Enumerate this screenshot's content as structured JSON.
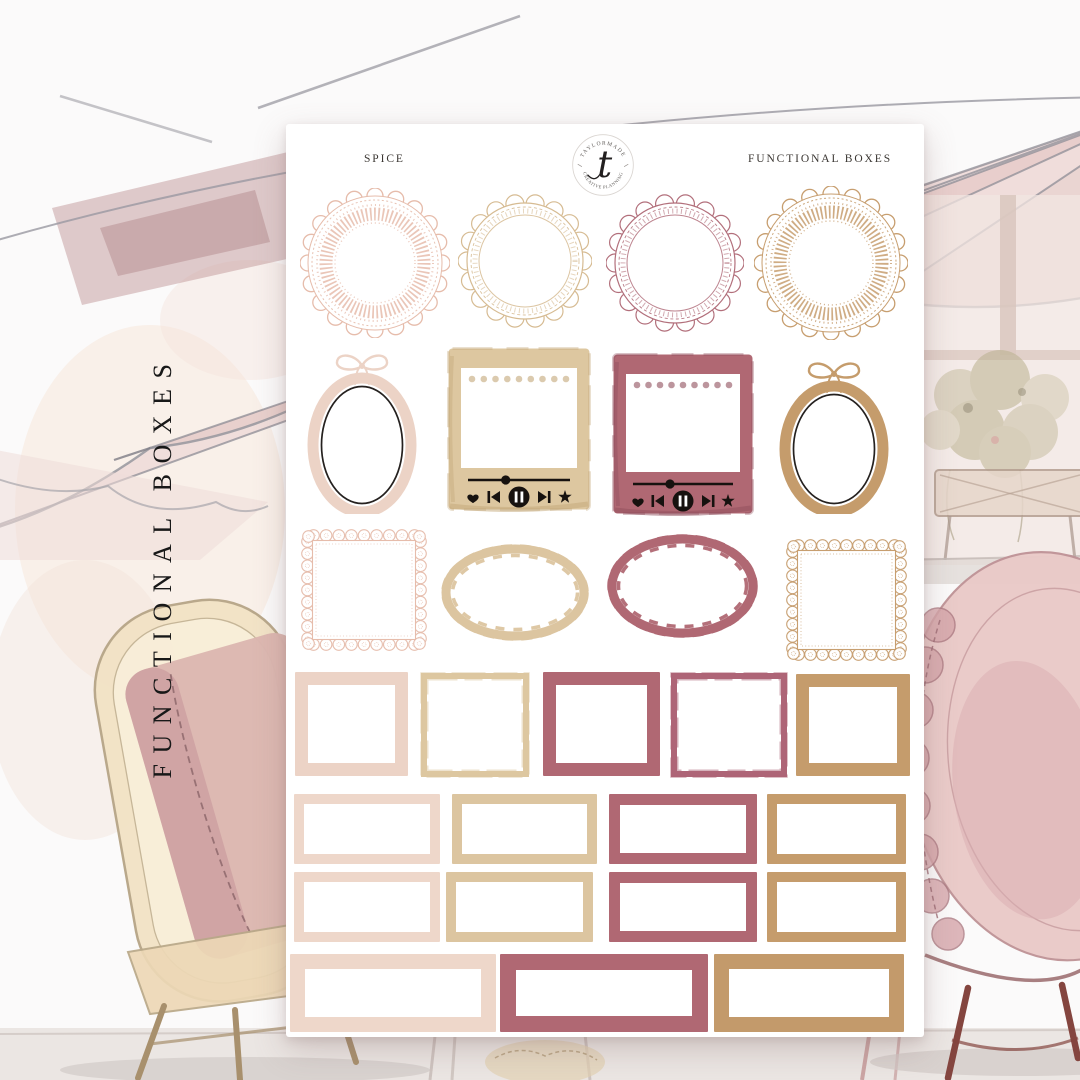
{
  "page": {
    "vertical_label": "FUNCTIONAL BOXES"
  },
  "sheet": {
    "header": {
      "collection": "SPICE",
      "product": "FUNCTIONAL BOXES"
    },
    "logo": {
      "top_arc": "TAYLORMADE",
      "bottom_arc": "CREATIVE PLANNING",
      "monogram": "t"
    }
  },
  "colors": {
    "blush": "#ecd3c6",
    "blush_light": "#eed7ca",
    "cream": "#ddc7a0",
    "cream_dark": "#c3a778",
    "tan": "#dcc5a0",
    "mauve": "#b06873",
    "mauve_brush": "#ae6577",
    "mauve_dark": "#8f4e5c",
    "camel": "#c59c6c",
    "camel_deep": "#c39a6b",
    "doily_blush": "#e6bcab",
    "doily_cream": "#d6bb92",
    "doily_mauve": "#b26f7b",
    "doily_camel": "#c79e6f",
    "ink": "#1c1c1c",
    "sheet": "#ffffff"
  },
  "stickers": {
    "rows": [
      {
        "id": "doilies",
        "items": [
          {
            "shape": "doily-wide",
            "color": "doily_blush",
            "name": "doily-sticker-blush"
          },
          {
            "shape": "doily-thin",
            "color": "doily_cream",
            "name": "doily-sticker-cream"
          },
          {
            "shape": "doily-thin",
            "color": "doily_mauve",
            "name": "doily-sticker-mauve"
          },
          {
            "shape": "doily-wide",
            "color": "doily_camel",
            "name": "doily-sticker-camel"
          }
        ]
      },
      {
        "id": "oval-frames-and-players",
        "items": [
          {
            "shape": "oval-bow",
            "color": "blush",
            "name": "oval-bow-frame-blush"
          },
          {
            "shape": "music-player",
            "color": "cream",
            "color2": "cream_dark",
            "name": "music-player-sticker-cream"
          },
          {
            "shape": "music-player",
            "color": "mauve",
            "color2": "mauve_dark",
            "name": "music-player-sticker-mauve"
          },
          {
            "shape": "oval-bow",
            "color": "camel",
            "name": "oval-bow-frame-camel"
          }
        ]
      },
      {
        "id": "lace-squares-and-wavy-ovals",
        "items": [
          {
            "shape": "lace-square",
            "color": "doily_blush",
            "name": "lace-square-frame-blush"
          },
          {
            "shape": "wavy-oval",
            "color": "tan",
            "name": "wavy-oval-frame-tan"
          },
          {
            "shape": "wavy-oval",
            "color": "mauve",
            "name": "wavy-oval-frame-mauve"
          },
          {
            "shape": "lace-square",
            "color": "doily_camel",
            "name": "lace-square-frame-camel"
          }
        ]
      },
      {
        "id": "full-boxes",
        "items": [
          {
            "shape": "solid-box",
            "color": "blush",
            "name": "full-box-blush"
          },
          {
            "shape": "brush-box",
            "color": "cream",
            "name": "full-box-brushstroke-cream"
          },
          {
            "shape": "solid-box",
            "color": "mauve",
            "name": "full-box-mauve"
          },
          {
            "shape": "brush-box",
            "color": "mauve_brush",
            "name": "full-box-brushstroke-mauve"
          },
          {
            "shape": "solid-box",
            "color": "camel",
            "name": "full-box-camel"
          }
        ]
      },
      {
        "id": "half-boxes-row-1",
        "items": [
          {
            "shape": "solid-box",
            "color": "blush_light",
            "name": "half-box-blush"
          },
          {
            "shape": "solid-box",
            "color": "tan",
            "name": "half-box-tan"
          },
          {
            "shape": "solid-box",
            "color": "mauve",
            "name": "half-box-mauve"
          },
          {
            "shape": "solid-box",
            "color": "camel",
            "name": "half-box-camel"
          }
        ]
      },
      {
        "id": "half-boxes-row-2",
        "items": [
          {
            "shape": "solid-box",
            "color": "blush_light",
            "name": "half-box-blush-2"
          },
          {
            "shape": "solid-box",
            "color": "tan",
            "name": "half-box-tan-2"
          },
          {
            "shape": "solid-box",
            "color": "mauve",
            "name": "half-box-mauve-2"
          },
          {
            "shape": "solid-box",
            "color": "camel",
            "name": "half-box-camel-2"
          }
        ]
      },
      {
        "id": "long-boxes",
        "items": [
          {
            "shape": "solid-box",
            "color": "blush_light",
            "name": "long-box-blush"
          },
          {
            "shape": "solid-box",
            "color": "mauve",
            "name": "long-box-mauve"
          },
          {
            "shape": "solid-box",
            "color": "camel_deep",
            "name": "long-box-camel"
          }
        ]
      }
    ]
  }
}
